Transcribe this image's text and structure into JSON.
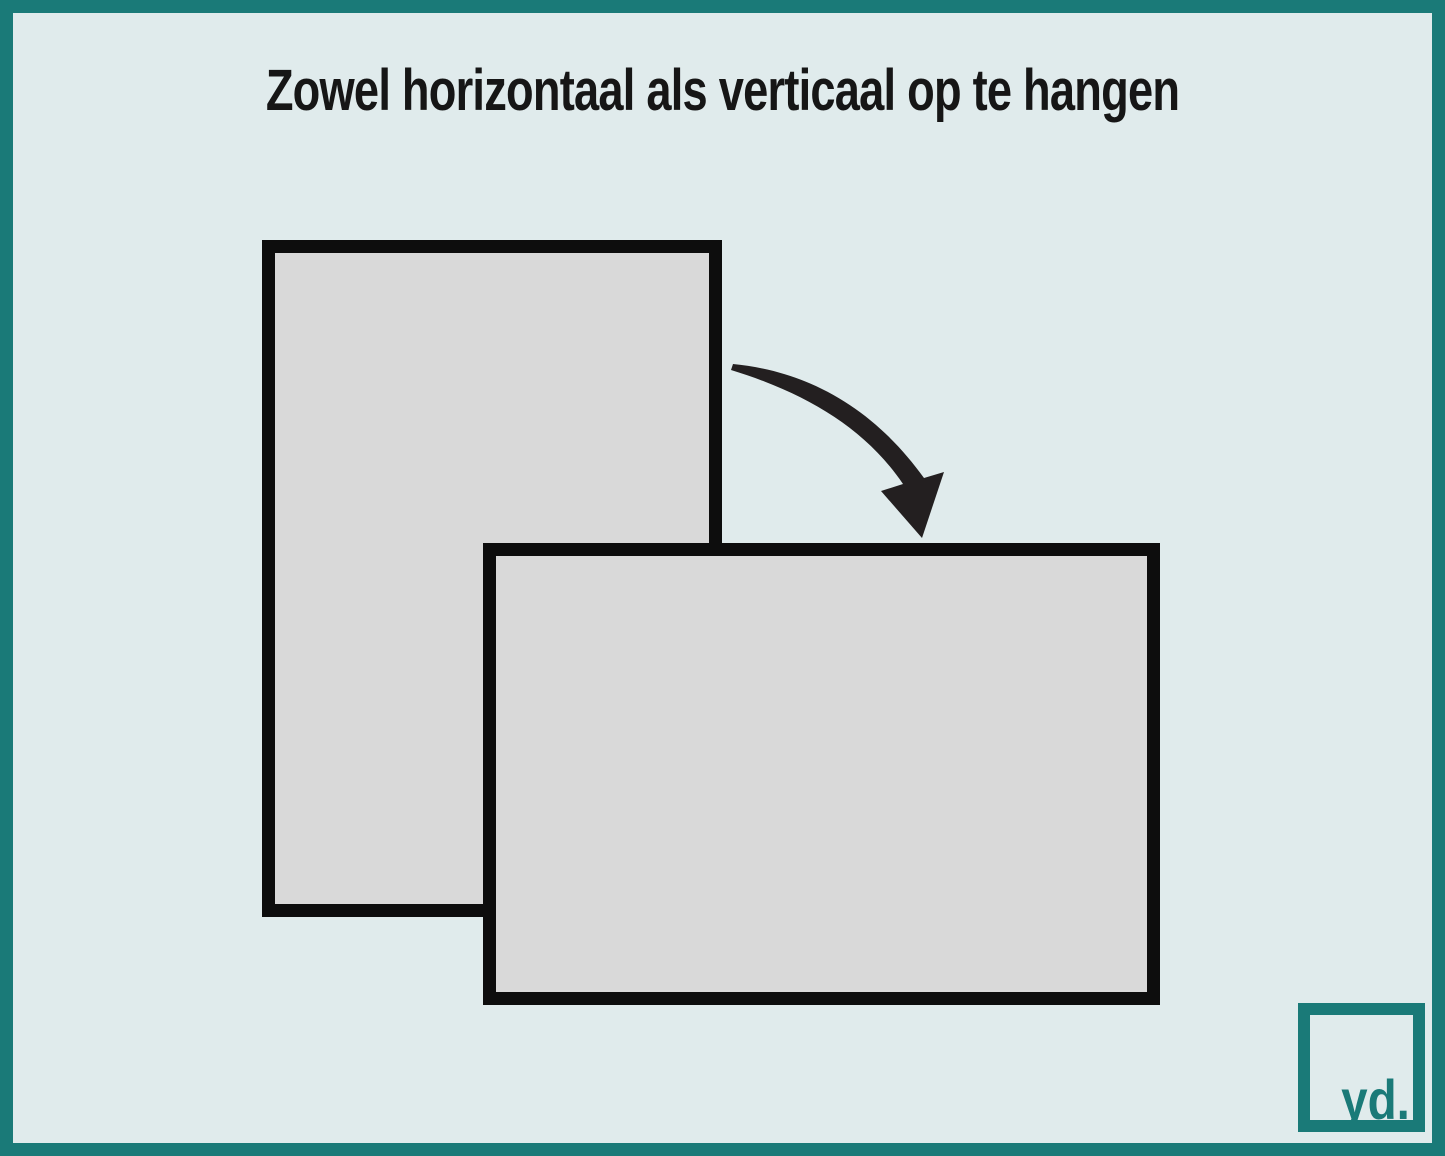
{
  "title": {
    "text": "Zowel horizontaal als verticaal op te hangen"
  },
  "illustration": {
    "portrait_frame": {
      "orientation": "vertical"
    },
    "landscape_frame": {
      "orientation": "horizontal"
    },
    "arrow_icon": "rotate-clockwise-arrow"
  },
  "logo": {
    "text": "yd."
  },
  "colors": {
    "border_teal": "#1a7a78",
    "background": "#e0ebec",
    "frame_fill": "#d9d9d9",
    "frame_border": "#0d0d0d",
    "arrow_ink": "#231f20",
    "title_ink": "#161616"
  }
}
